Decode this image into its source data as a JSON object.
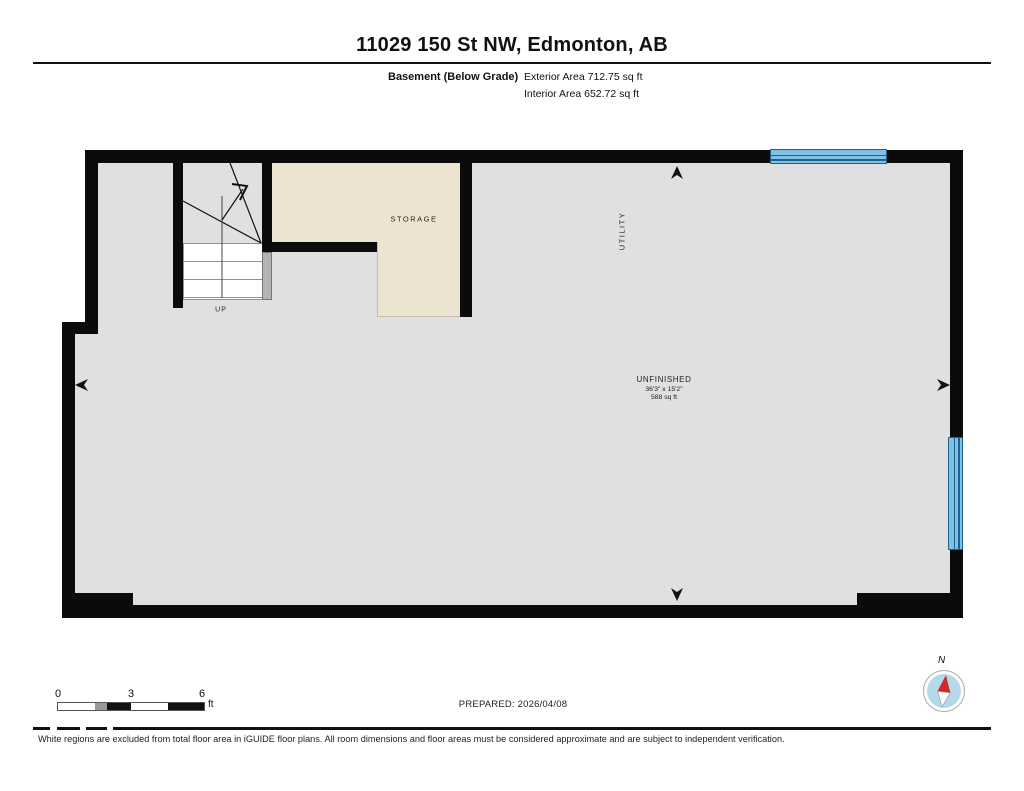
{
  "header": {
    "title": "11029 150 St NW, Edmonton, AB",
    "floor_label": "Basement (Below Grade)",
    "exterior_area": "Exterior Area 712.75 sq ft",
    "interior_area": "Interior Area 652.72 sq ft"
  },
  "plan": {
    "rooms": {
      "storage": {
        "label": "STORAGE"
      },
      "utility": {
        "label": "UTILITY"
      },
      "unfinished": {
        "label": "UNFINISHED",
        "dimensions": "36'3\" x 15'2\"",
        "area": "588 sq ft"
      },
      "stairs": {
        "direction_label": "UP"
      }
    },
    "colors": {
      "wall": "#0b0b0b",
      "floor": "#e0e0e0",
      "storage_floor": "#ece3d1",
      "window_fill": "#7fc0e4",
      "window_line": "#1d618c",
      "handrail": "#b3b3b3",
      "compass_needle": "#cf2b24"
    }
  },
  "footer": {
    "scale": {
      "ticks": [
        "0",
        "3",
        "6"
      ],
      "unit": "ft"
    },
    "prepared": "PREPARED: 2026/04/08",
    "compass_label": "N",
    "disclaimer": "White regions are excluded from total floor area in iGUIDE floor plans. All room dimensions and floor areas must be considered approximate and are subject to independent verification."
  }
}
